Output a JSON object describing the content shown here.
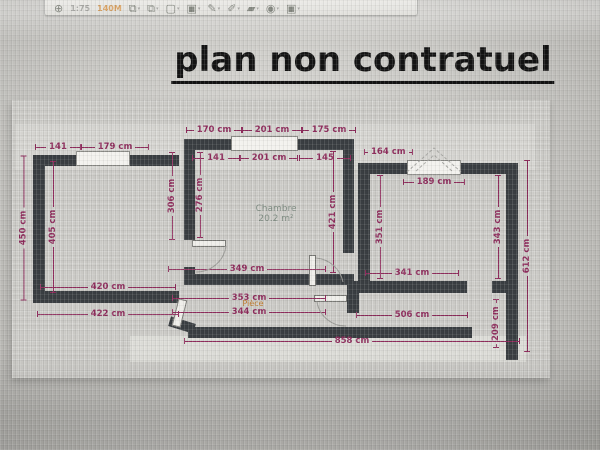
{
  "title": "plan non contratuel",
  "toolbar": {
    "items": [
      {
        "name": "compass-icon",
        "glyph": "⊕",
        "type": "icon"
      },
      {
        "name": "scale-text",
        "glyph": "1:75",
        "type": "text",
        "color": "#8e8e8a"
      },
      {
        "name": "zoom-badge",
        "glyph": "140M",
        "type": "text",
        "color": "#cd8430"
      },
      {
        "name": "copy-icon",
        "glyph": "⧉",
        "type": "icon",
        "drop": true
      },
      {
        "name": "duplicate-icon",
        "glyph": "⧉",
        "type": "icon",
        "drop": true
      },
      {
        "name": "new-page-icon",
        "glyph": "▢",
        "type": "icon",
        "drop": true
      },
      {
        "name": "pages-icon",
        "glyph": "▣",
        "type": "icon",
        "drop": true
      },
      {
        "name": "pencil-icon",
        "glyph": "✎",
        "type": "icon",
        "drop": true
      },
      {
        "name": "pen-icon",
        "glyph": "✐",
        "type": "icon",
        "drop": true
      },
      {
        "name": "eraser-icon",
        "glyph": "▰",
        "type": "icon",
        "drop": true
      },
      {
        "name": "eye-icon",
        "glyph": "◉",
        "type": "icon",
        "drop": true
      },
      {
        "name": "printer-icon",
        "glyph": "▣",
        "type": "icon",
        "drop": true
      }
    ]
  },
  "plan": {
    "colors": {
      "wall": "#3a3e42",
      "dimension": "#8e2c5c",
      "window_fill": "#f3f2ee",
      "room_label": "#7e8c82",
      "piece_label": "#c07a2a",
      "paper": "#cac9c5",
      "arc": "#9b9b97"
    },
    "walls": [
      {
        "x": 33,
        "y": 155,
        "w": 146,
        "h": 11
      },
      {
        "x": 33,
        "y": 155,
        "w": 12,
        "h": 148
      },
      {
        "x": 33,
        "y": 291,
        "w": 146,
        "h": 12
      },
      {
        "x": 184,
        "y": 139,
        "w": 11,
        "h": 101
      },
      {
        "x": 184,
        "y": 267,
        "w": 11,
        "h": 18
      },
      {
        "x": 184,
        "y": 139,
        "w": 170,
        "h": 11
      },
      {
        "x": 343,
        "y": 139,
        "w": 11,
        "h": 114
      },
      {
        "x": 184,
        "y": 274,
        "w": 170,
        "h": 11
      },
      {
        "x": 188,
        "y": 327,
        "w": 284,
        "h": 11
      },
      {
        "x": 169,
        "y": 320,
        "w": 26,
        "h": 10,
        "r": 17
      },
      {
        "x": 358,
        "y": 163,
        "w": 160,
        "h": 11
      },
      {
        "x": 358,
        "y": 163,
        "w": 12,
        "h": 129
      },
      {
        "x": 506,
        "y": 163,
        "w": 12,
        "h": 131
      },
      {
        "x": 347,
        "y": 281,
        "w": 120,
        "h": 12
      },
      {
        "x": 347,
        "y": 281,
        "w": 12,
        "h": 32
      },
      {
        "x": 492,
        "y": 281,
        "w": 14,
        "h": 12
      },
      {
        "x": 506,
        "y": 294,
        "w": 12,
        "h": 66
      }
    ],
    "windows": [
      {
        "x": 76,
        "y": 151,
        "w": 54,
        "h": 15
      },
      {
        "x": 231,
        "y": 136,
        "w": 67,
        "h": 15
      },
      {
        "x": 407,
        "y": 160,
        "w": 54,
        "h": 15
      }
    ],
    "door_leaves": [
      {
        "x": 192,
        "y": 240,
        "w": 34,
        "h": 7
      },
      {
        "x": 309,
        "y": 255,
        "w": 7,
        "h": 31
      },
      {
        "x": 175,
        "y": 299,
        "w": 9,
        "h": 28,
        "r": 14
      },
      {
        "x": 314,
        "y": 295,
        "w": 33,
        "h": 7
      }
    ],
    "arcs": [
      "M 226 246 A 30 30 0 0 1 196 272",
      "M 316 258 A 30 30 0 0 1 343 282",
      "M 317 302 A 29 29 0 0 0 346 326"
    ],
    "dashed": [
      "M 407 172 L 434 148 L 461 172",
      "M 416 171 L 434 155 L 452 171"
    ],
    "dimensions": [
      {
        "t": "141",
        "x": 58,
        "y": 147,
        "l": 46,
        "o": "h"
      },
      {
        "t": "179 cm",
        "x": 115,
        "y": 147,
        "l": 68,
        "o": "h"
      },
      {
        "t": "170 cm",
        "x": 214,
        "y": 130,
        "l": 56,
        "o": "h"
      },
      {
        "t": "201 cm",
        "x": 272,
        "y": 130,
        "l": 60,
        "o": "h"
      },
      {
        "t": "175 cm",
        "x": 329,
        "y": 130,
        "l": 54,
        "o": "h"
      },
      {
        "t": "141",
        "x": 216,
        "y": 158,
        "l": 48,
        "o": "h"
      },
      {
        "t": "201 cm",
        "x": 269,
        "y": 158,
        "l": 58,
        "o": "h"
      },
      {
        "t": "145",
        "x": 325,
        "y": 158,
        "l": 52,
        "o": "h"
      },
      {
        "t": "164 cm",
        "x": 386,
        "y": 152,
        "l": 44,
        "o": "h"
      },
      {
        "t": "189 cm",
        "x": 434,
        "y": 182,
        "l": 62,
        "o": "h"
      },
      {
        "t": "450 cm",
        "x": 23,
        "y": 228,
        "l": 145,
        "o": "v"
      },
      {
        "t": "405 cm",
        "x": 53,
        "y": 227,
        "l": 132,
        "o": "v"
      },
      {
        "t": "306 cm",
        "x": 172,
        "y": 196,
        "l": 88,
        "o": "v"
      },
      {
        "t": "276 cm",
        "x": 200,
        "y": 195,
        "l": 86,
        "o": "v"
      },
      {
        "t": "421 cm",
        "x": 333,
        "y": 212,
        "l": 122,
        "o": "v"
      },
      {
        "t": "351 cm",
        "x": 380,
        "y": 227,
        "l": 104,
        "o": "v"
      },
      {
        "t": "343 cm",
        "x": 498,
        "y": 227,
        "l": 104,
        "o": "v"
      },
      {
        "t": "612 cm",
        "x": 527,
        "y": 256,
        "l": 192,
        "o": "v"
      },
      {
        "t": "209 cm",
        "x": 496,
        "y": 324,
        "l": 48,
        "o": "v"
      },
      {
        "t": "349 cm",
        "x": 247,
        "y": 269,
        "l": 158,
        "o": "h"
      },
      {
        "t": "420 cm",
        "x": 108,
        "y": 287,
        "l": 136,
        "o": "h"
      },
      {
        "t": "422 cm",
        "x": 108,
        "y": 314,
        "l": 142,
        "o": "h"
      },
      {
        "t": "353 cm",
        "x": 249,
        "y": 298,
        "l": 154,
        "o": "h"
      },
      {
        "t": "344 cm",
        "x": 249,
        "y": 312,
        "l": 154,
        "o": "h"
      },
      {
        "t": "341 cm",
        "x": 412,
        "y": 273,
        "l": 94,
        "o": "h"
      },
      {
        "t": "506 cm",
        "x": 412,
        "y": 315,
        "l": 112,
        "o": "h"
      },
      {
        "t": "858 cm",
        "x": 352,
        "y": 341,
        "l": 336,
        "o": "h"
      }
    ],
    "room_labels": [
      {
        "lines": [
          "Chambre",
          "20.2 m²"
        ],
        "x": 276,
        "y": 214,
        "cls": ""
      },
      {
        "lines": [
          "Pièce"
        ],
        "x": 253,
        "y": 304,
        "cls": "orange"
      }
    ]
  }
}
